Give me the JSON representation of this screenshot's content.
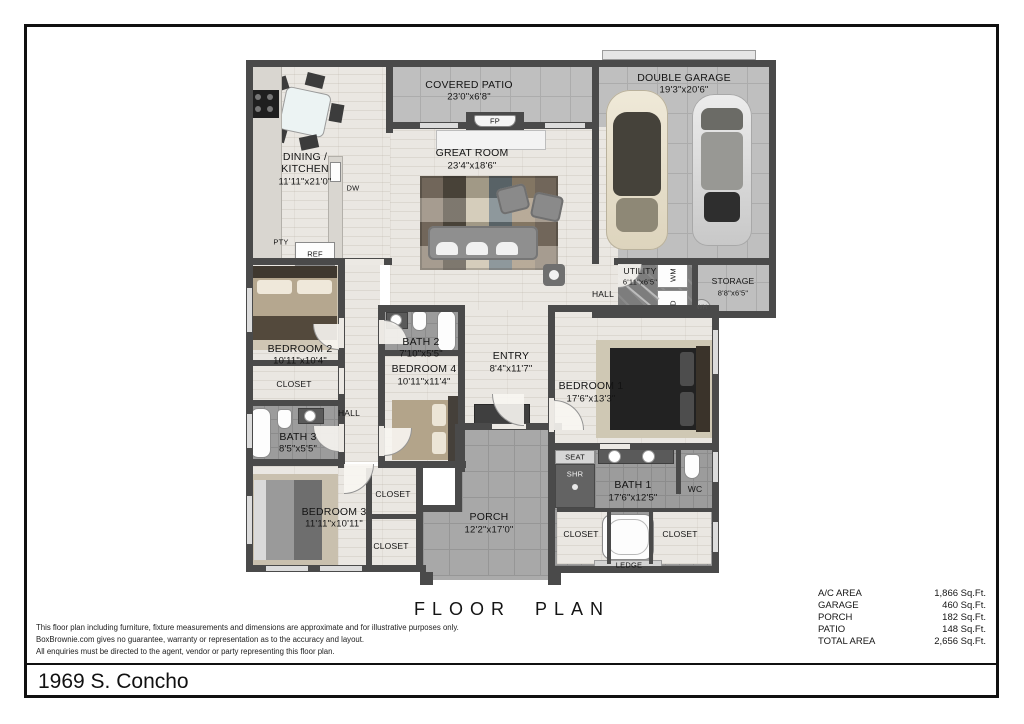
{
  "plan": {
    "rooms": [
      {
        "id": "covered-patio",
        "name": "COVERED PATIO",
        "dims": "23'0\"x6'8\""
      },
      {
        "id": "double-garage",
        "name": "DOUBLE GARAGE",
        "dims": "19'3\"x20'6\""
      },
      {
        "id": "dining-kitchen",
        "name1": "DINING /",
        "name2": "KITCHEN",
        "dims": "11'11\"x21'0\""
      },
      {
        "id": "great-room",
        "name": "GREAT ROOM",
        "dims": "23'4\"x18'6\""
      },
      {
        "id": "utility",
        "name": "UTILITY",
        "dims": "6'11\"x6'5\""
      },
      {
        "id": "storage",
        "name": "STORAGE",
        "dims": "8'8\"x6'5\""
      },
      {
        "id": "bedroom-2",
        "name": "BEDROOM 2",
        "dims": "10'11\"x10'4\""
      },
      {
        "id": "bath-2",
        "name": "BATH 2",
        "dims": "7'10\"x5'5\""
      },
      {
        "id": "bedroom-4",
        "name": "BEDROOM 4",
        "dims": "10'11\"x11'4\""
      },
      {
        "id": "entry",
        "name": "ENTRY",
        "dims": "8'4\"x11'7\""
      },
      {
        "id": "bedroom-1",
        "name": "BEDROOM 1",
        "dims": "17'6\"x13'3\""
      },
      {
        "id": "bath-3",
        "name": "BATH 3",
        "dims": "8'5\"x5'5\""
      },
      {
        "id": "bedroom-3",
        "name": "BEDROOM 3",
        "dims": "11'11\"x10'11\""
      },
      {
        "id": "porch",
        "name": "PORCH",
        "dims": "12'2\"x17'0\""
      },
      {
        "id": "bath-1",
        "name": "BATH 1",
        "dims": "17'6\"x12'5\""
      }
    ],
    "fixtures": {
      "fp": "FP",
      "dw": "DW",
      "pty": "PTY",
      "ref": "REF",
      "hall": "HALL",
      "wm": "WM",
      "d": "D",
      "wh": "WH",
      "closet": "CLOSET",
      "seat": "SEAT",
      "shr": "SHR",
      "wc": "WC",
      "ledge": "LEDGE"
    }
  },
  "footer": {
    "plan_title": "FLOOR PLAN",
    "disclaimer": [
      "This floor plan including furniture, fixture measurements and dimensions are approximate and for illustrative purposes only.",
      "BoxBrownie.com gives no guarantee, warranty or representation as to the accuracy and layout.",
      "All enquiries must be directed to the agent, vendor or party representing this floor plan."
    ],
    "areas": [
      {
        "label": "A/C AREA",
        "value": "1,866 Sq.Ft."
      },
      {
        "label": "GARAGE",
        "value": "460 Sq.Ft."
      },
      {
        "label": "PORCH",
        "value": "182 Sq.Ft."
      },
      {
        "label": "PATIO",
        "value": "148 Sq.Ft."
      },
      {
        "label": "TOTAL AREA",
        "value": "2,656 Sq.Ft."
      }
    ],
    "address": "1969 S. Concho"
  },
  "colors": {
    "wall": "#4a4a4a",
    "floor": "#eae7e2",
    "concrete": "#bfbfbf",
    "ink": "#101010"
  }
}
